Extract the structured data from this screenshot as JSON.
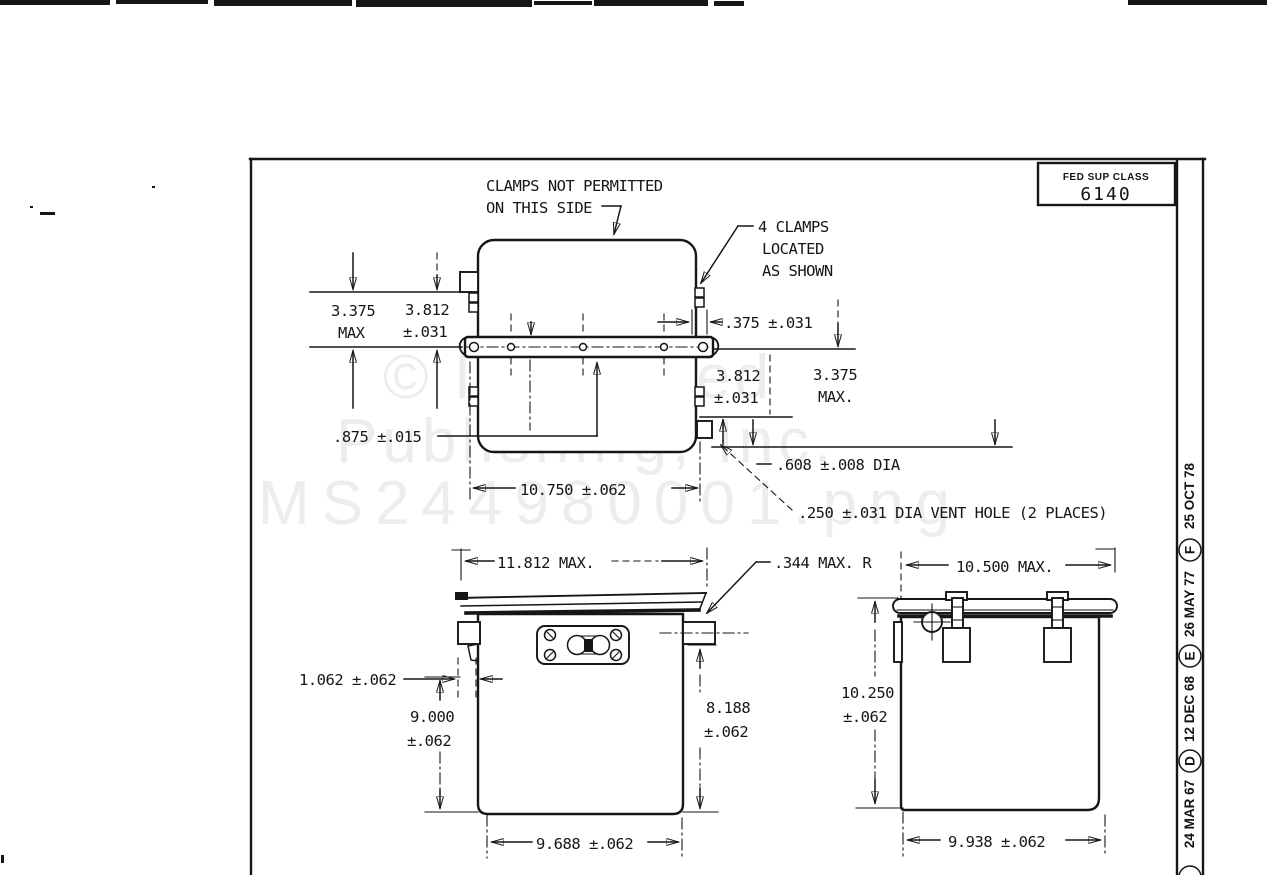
{
  "watermark": {
    "line1": "© Integrated",
    "line2": "Publishing, Inc.",
    "line3": "MS244980001.png"
  },
  "title_block": {
    "fed_sup_class_label": "FED SUP CLASS",
    "fed_sup_class_value": "6140"
  },
  "revision_strip": {
    "entries": [
      {
        "letter": "",
        "date": "24 MAR 67"
      },
      {
        "letter": "D",
        "date": "12 DEC 68"
      },
      {
        "letter": "E",
        "date": "26 MAY 77"
      },
      {
        "letter": "F",
        "date": "25 OCT 78"
      }
    ]
  },
  "notes": {
    "no_clamps_line1": "CLAMPS NOT PERMITTED",
    "no_clamps_line2": "ON THIS SIDE",
    "clamps_line1": "4 CLAMPS",
    "clamps_line2": "LOCATED",
    "clamps_line3": "AS SHOWN"
  },
  "top_view": {
    "dim_height_left_value": "3.375",
    "dim_height_left_suffix": "MAX",
    "dim_flange_left_value": "3.812",
    "dim_flange_left_tol": "±.031",
    "dim_clamp": ".375 ±.031",
    "dim_flange_right_value": "3.812",
    "dim_flange_right_tol": "±.031",
    "dim_height_right_value": "3.375",
    "dim_height_right_suffix": "MAX.",
    "dim_flange_thickness": ".875 ±.015",
    "dim_mount_span": "10.750 ±.062",
    "dim_boss": ".608 ±.008 DIA",
    "dim_vent": ".250 ±.031 DIA VENT HOLE (2 PLACES)"
  },
  "front_view": {
    "dim_width": "11.812 MAX.",
    "dim_radius": ".344 MAX. R",
    "dim_lip": "1.062 ±.062",
    "dim_height_value": "9.000",
    "dim_height_tol": "±.062",
    "dim_body_height_value": "8.188",
    "dim_body_height_tol": "±.062",
    "dim_base": "9.688 ±.062"
  },
  "side_view": {
    "dim_width": "10.500 MAX.",
    "dim_height_value": "10.250",
    "dim_height_tol": "±.062",
    "dim_base": "9.938 ±.062"
  }
}
